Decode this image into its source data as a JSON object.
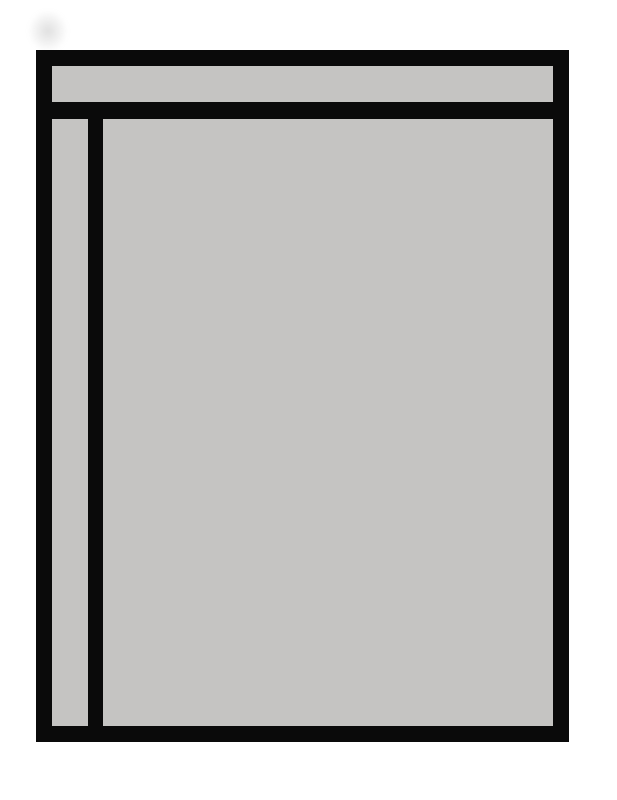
{
  "colors": {
    "background": "#ffffff",
    "panel_fill": "#c5c4c2",
    "line": "#0a0a0a"
  }
}
